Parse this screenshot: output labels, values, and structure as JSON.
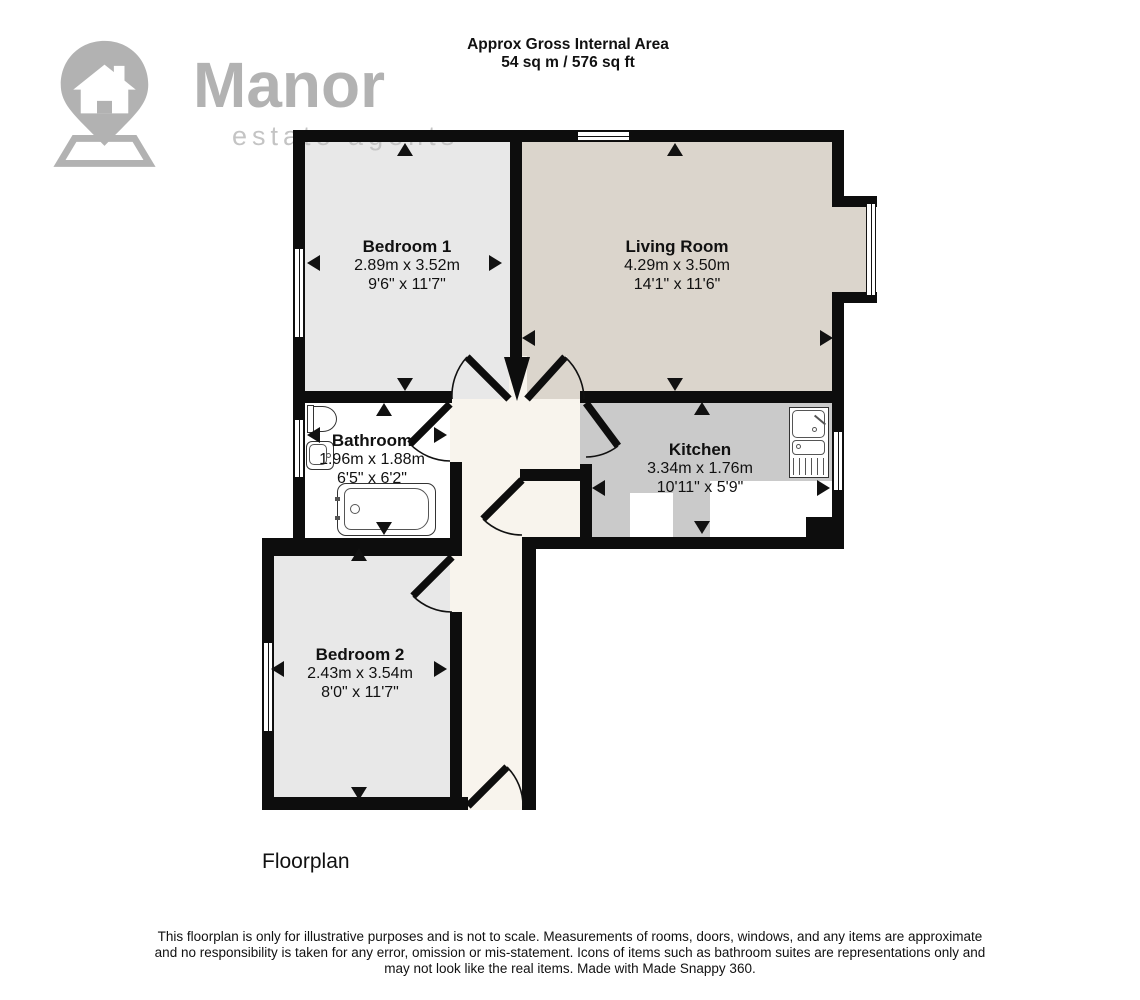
{
  "header": {
    "title": "Approx Gross Internal Area",
    "area": "54 sq m / 576 sq ft"
  },
  "logo": {
    "brand": "Manor",
    "tagline": "estate agents"
  },
  "rooms": [
    {
      "name": "Bedroom 1",
      "metric": "2.89m x 3.52m",
      "imperial": "9'6\" x 11'7\""
    },
    {
      "name": "Living Room",
      "metric": "4.29m x 3.50m",
      "imperial": "14'1\" x 11'6\""
    },
    {
      "name": "Bathroom",
      "metric": "1.96m x 1.88m",
      "imperial": "6'5\" x 6'2\""
    },
    {
      "name": "Kitchen",
      "metric": "3.34m x 1.76m",
      "imperial": "10'11\" x 5'9\""
    },
    {
      "name": "Bedroom 2",
      "metric": "2.43m x 3.54m",
      "imperial": "8'0\" x 11'7\""
    }
  ],
  "caption": "Floorplan",
  "disclaimer": [
    "This floorplan is only for illustrative purposes and is not to scale. Measurements of rooms, doors, windows, and any items are approximate",
    "and no responsibility is taken for any error, omission or mis-statement. Icons of items such as bathroom suites are representations only and",
    "may not look like the real items. Made with Made Snappy 360."
  ],
  "colors": {
    "wall": "#0d0d0d",
    "bedroom_fill": "#e8e8e8",
    "living_fill": "#dbd5cc",
    "kitchen_fill": "#cacaca",
    "bathroom_fill": "#ffffff",
    "hallway_fill": "#f8f4ed",
    "logo_gray": "#b2b2b2",
    "logo_light_gray": "#c4c4c4"
  }
}
